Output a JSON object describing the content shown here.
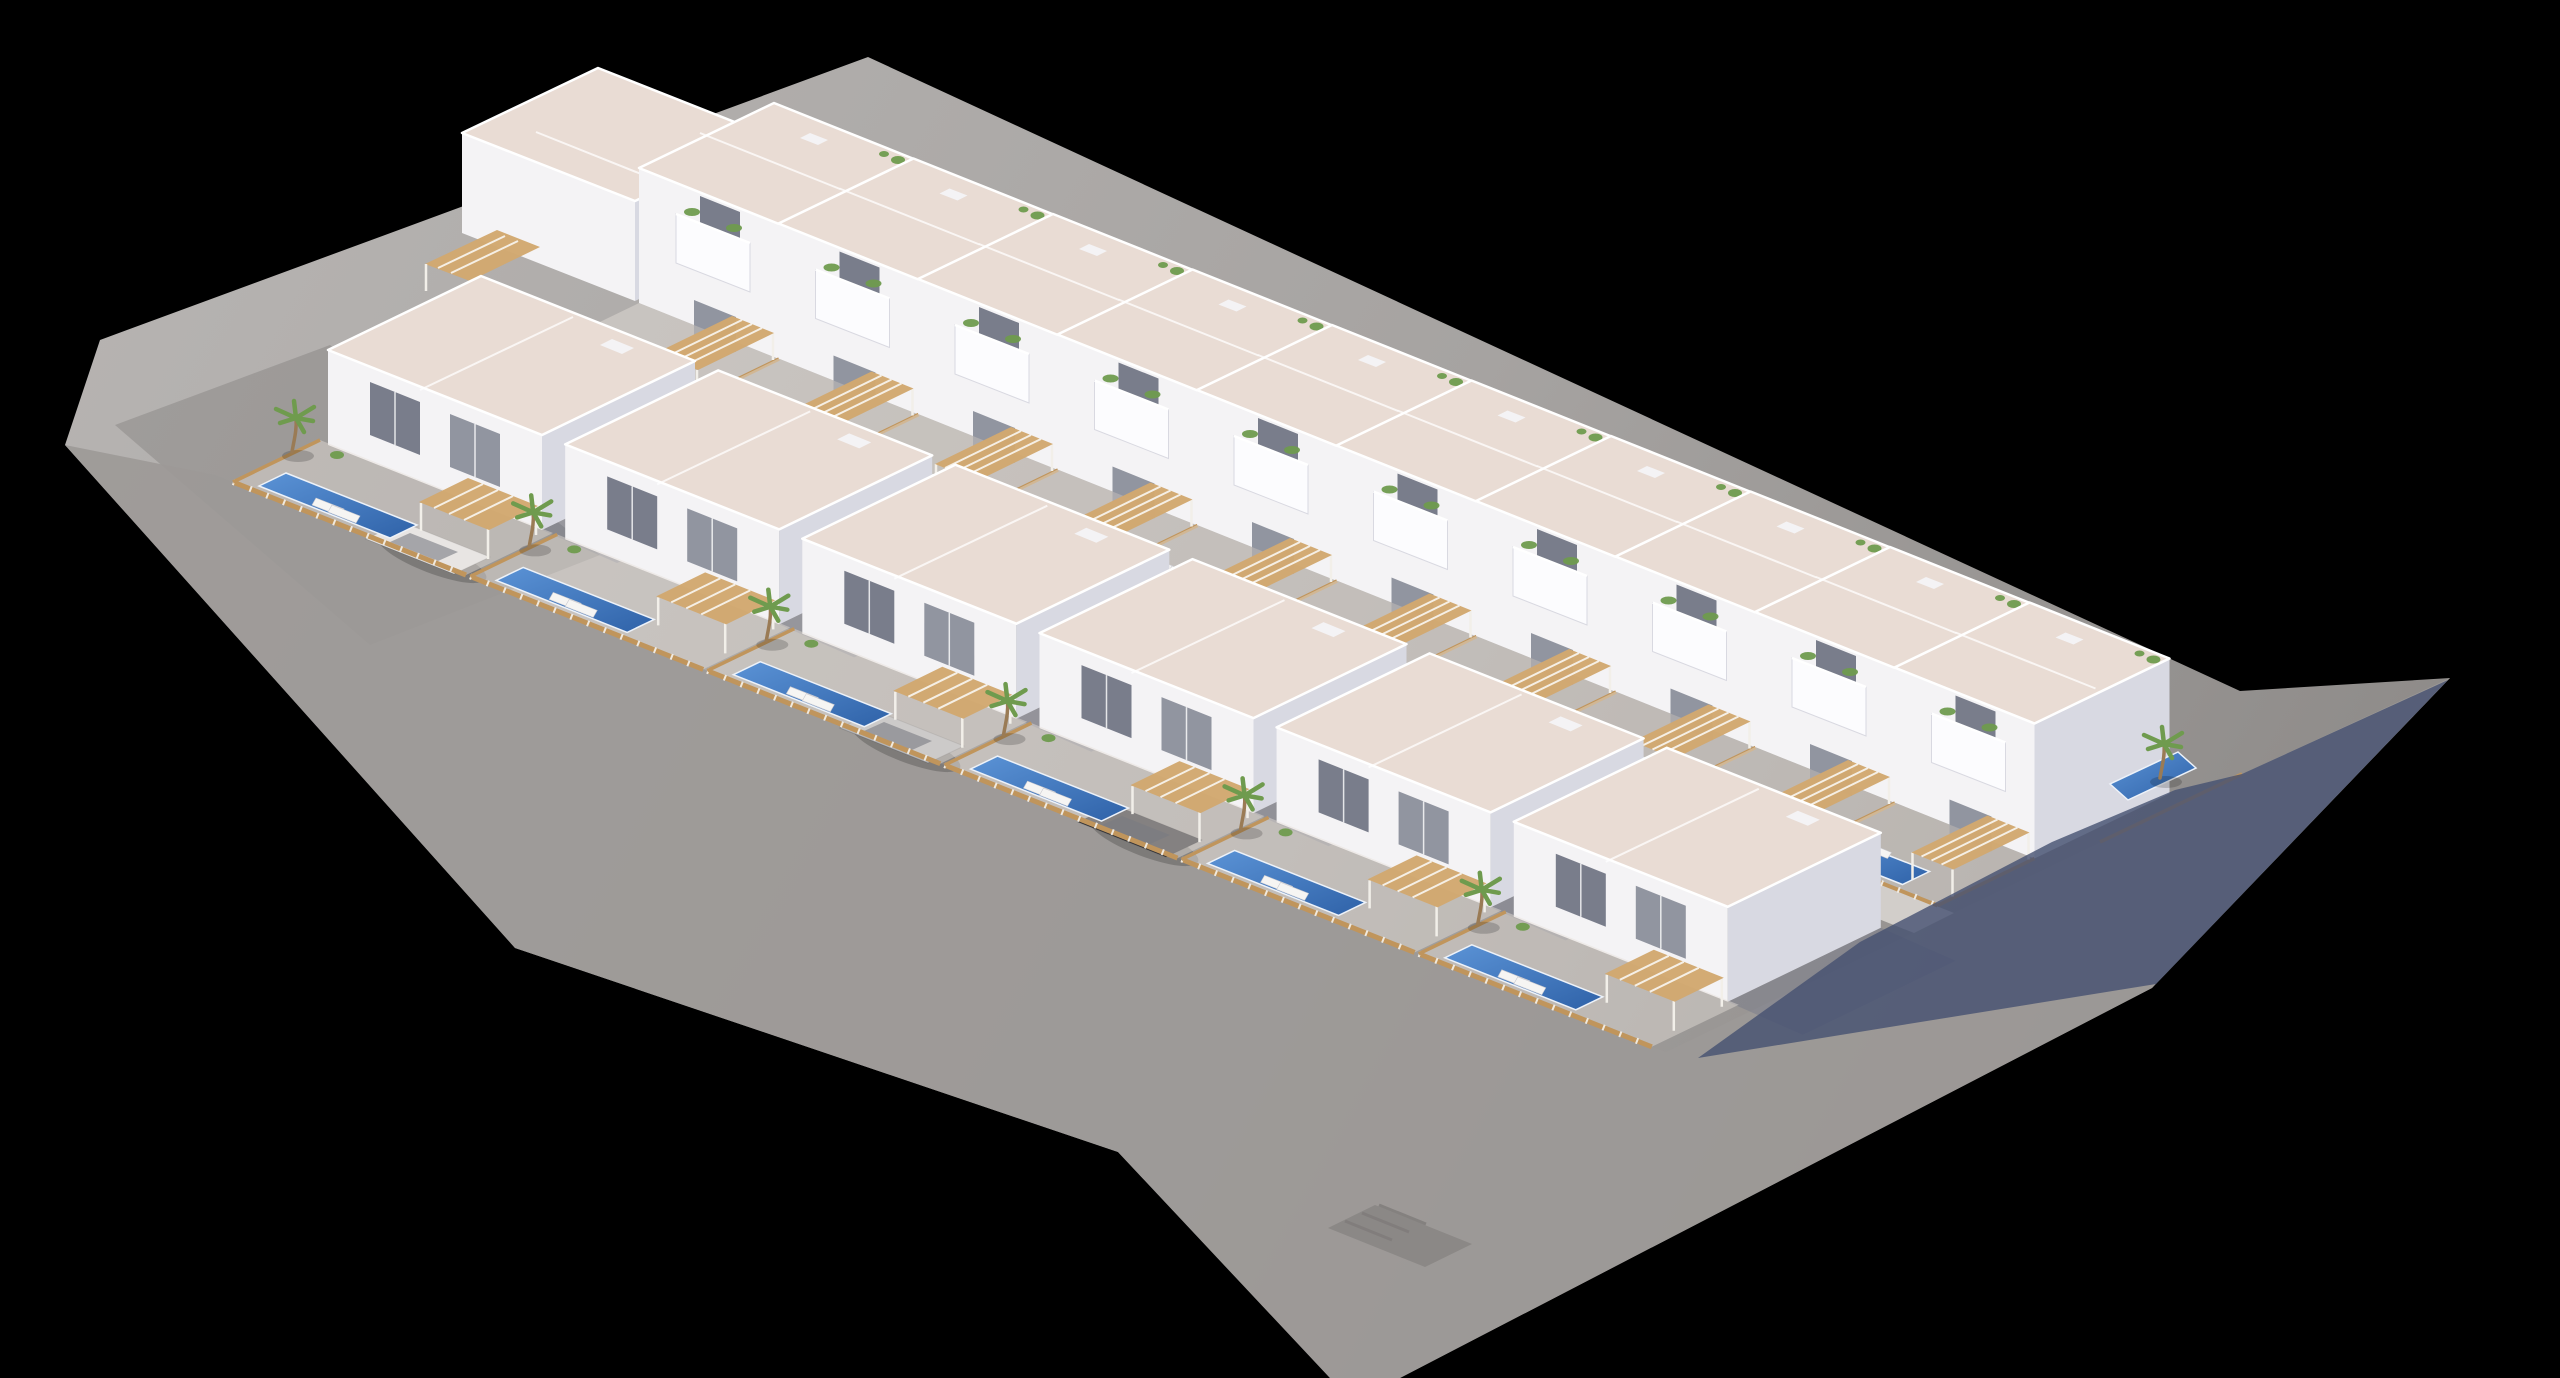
{
  "meta": {
    "title": "Aerial 3D render of residential development",
    "description": "Aerial isometric 3D architectural rendering of a white Mediterranean residential development: a back row of ten townhouses with balconies and planters, a front row of six detached villas, private gardens with blue pools, wooden slat fences, tan pergolas, sun loungers, palm trees and three parked cars, on a gray street block casting long blue shadows, against a black background"
  },
  "colors": {
    "background": "#000000",
    "ground_light": "#b6b3b1",
    "ground_mid": "#a6a3a1",
    "ground_dark": "#8e8b89",
    "road": "#9c9997",
    "path": "#dcd8d4",
    "wall": "#f4f3f5",
    "wall_shade": "#d8d9e2",
    "roof": "#e9dcd4",
    "parapet": "#ffffff",
    "window": "#6b7080",
    "fence": "#c0955c",
    "fence_post": "#f1ede6",
    "pergola": "#d2a86f",
    "pool_light": "#5b93d6",
    "pool_dark": "#2f62a8",
    "palm": "#6f9b4e",
    "palm_trunk": "#9a7b55",
    "shadow_navy": "#455070",
    "shadow_soft": "#5c6480",
    "lounger": "#f6f5f3",
    "patio": "#e6e0da",
    "crossing": "#8b8886",
    "car_white": "#e9e9eb",
    "car_silver": "#b7b8bc",
    "car_black": "#33343a"
  },
  "scene": {
    "type": "3d-architectural-render",
    "view": "aerial isometric, site long axis descending to the right",
    "background": "black",
    "buildings": {
      "back_row_townhouses": 10,
      "front_row_villas": 6,
      "auxiliary_block": 1
    },
    "amenities": {
      "private_pools": 18,
      "pergolas": 17,
      "palm_trees": 7,
      "sun_lounger_pairs": 16,
      "balconies_with_planters": 10
    },
    "vehicles": [
      {
        "type": "car",
        "color": "white"
      },
      {
        "type": "car",
        "color": "silver"
      },
      {
        "type": "car",
        "color": "black"
      }
    ],
    "streets": {
      "front_street": "wraps lower-left and lower-right of block",
      "back_street": "narrow lane behind back row",
      "pedestrian_crossing": "dark paved patch near bottom corner",
      "shadows": "long blue-navy shadows cast toward the lower right"
    }
  }
}
